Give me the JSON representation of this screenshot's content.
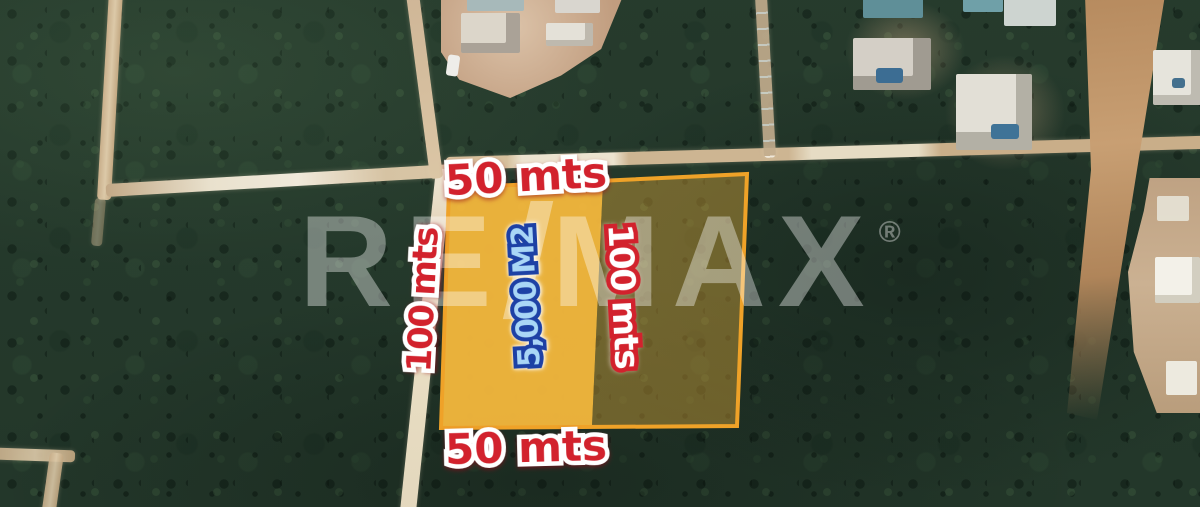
{
  "watermark": {
    "prefix": "RE",
    "slash": "/",
    "suffix": "MAX",
    "registered_mark": "®",
    "color": "#ffffff",
    "opacity": 0.38
  },
  "annotations": {
    "top_width_label": "50 mts",
    "bottom_width_label": "50 mts",
    "left_depth_label": "100 mts",
    "inner_depth_label": "100 mts",
    "area_label": "5,000 M2"
  },
  "colors": {
    "label_red": "#d2222d",
    "label_outline_white": "#ffffff",
    "area_label_fill": "#a9d6f6",
    "area_label_outline": "#1d41a5",
    "parcel_fill": "#f1b63c",
    "parcel_border": "#efa228",
    "forest_base": "#253a2c",
    "road_tan": "#d3bc98"
  },
  "parcel": {
    "outline_points": "449,188 747,174 737,426 441,428",
    "solid_points": "449,188 603,182 592,426 441,428",
    "overlay_points": "603,182 747,174 737,426 592,426"
  }
}
